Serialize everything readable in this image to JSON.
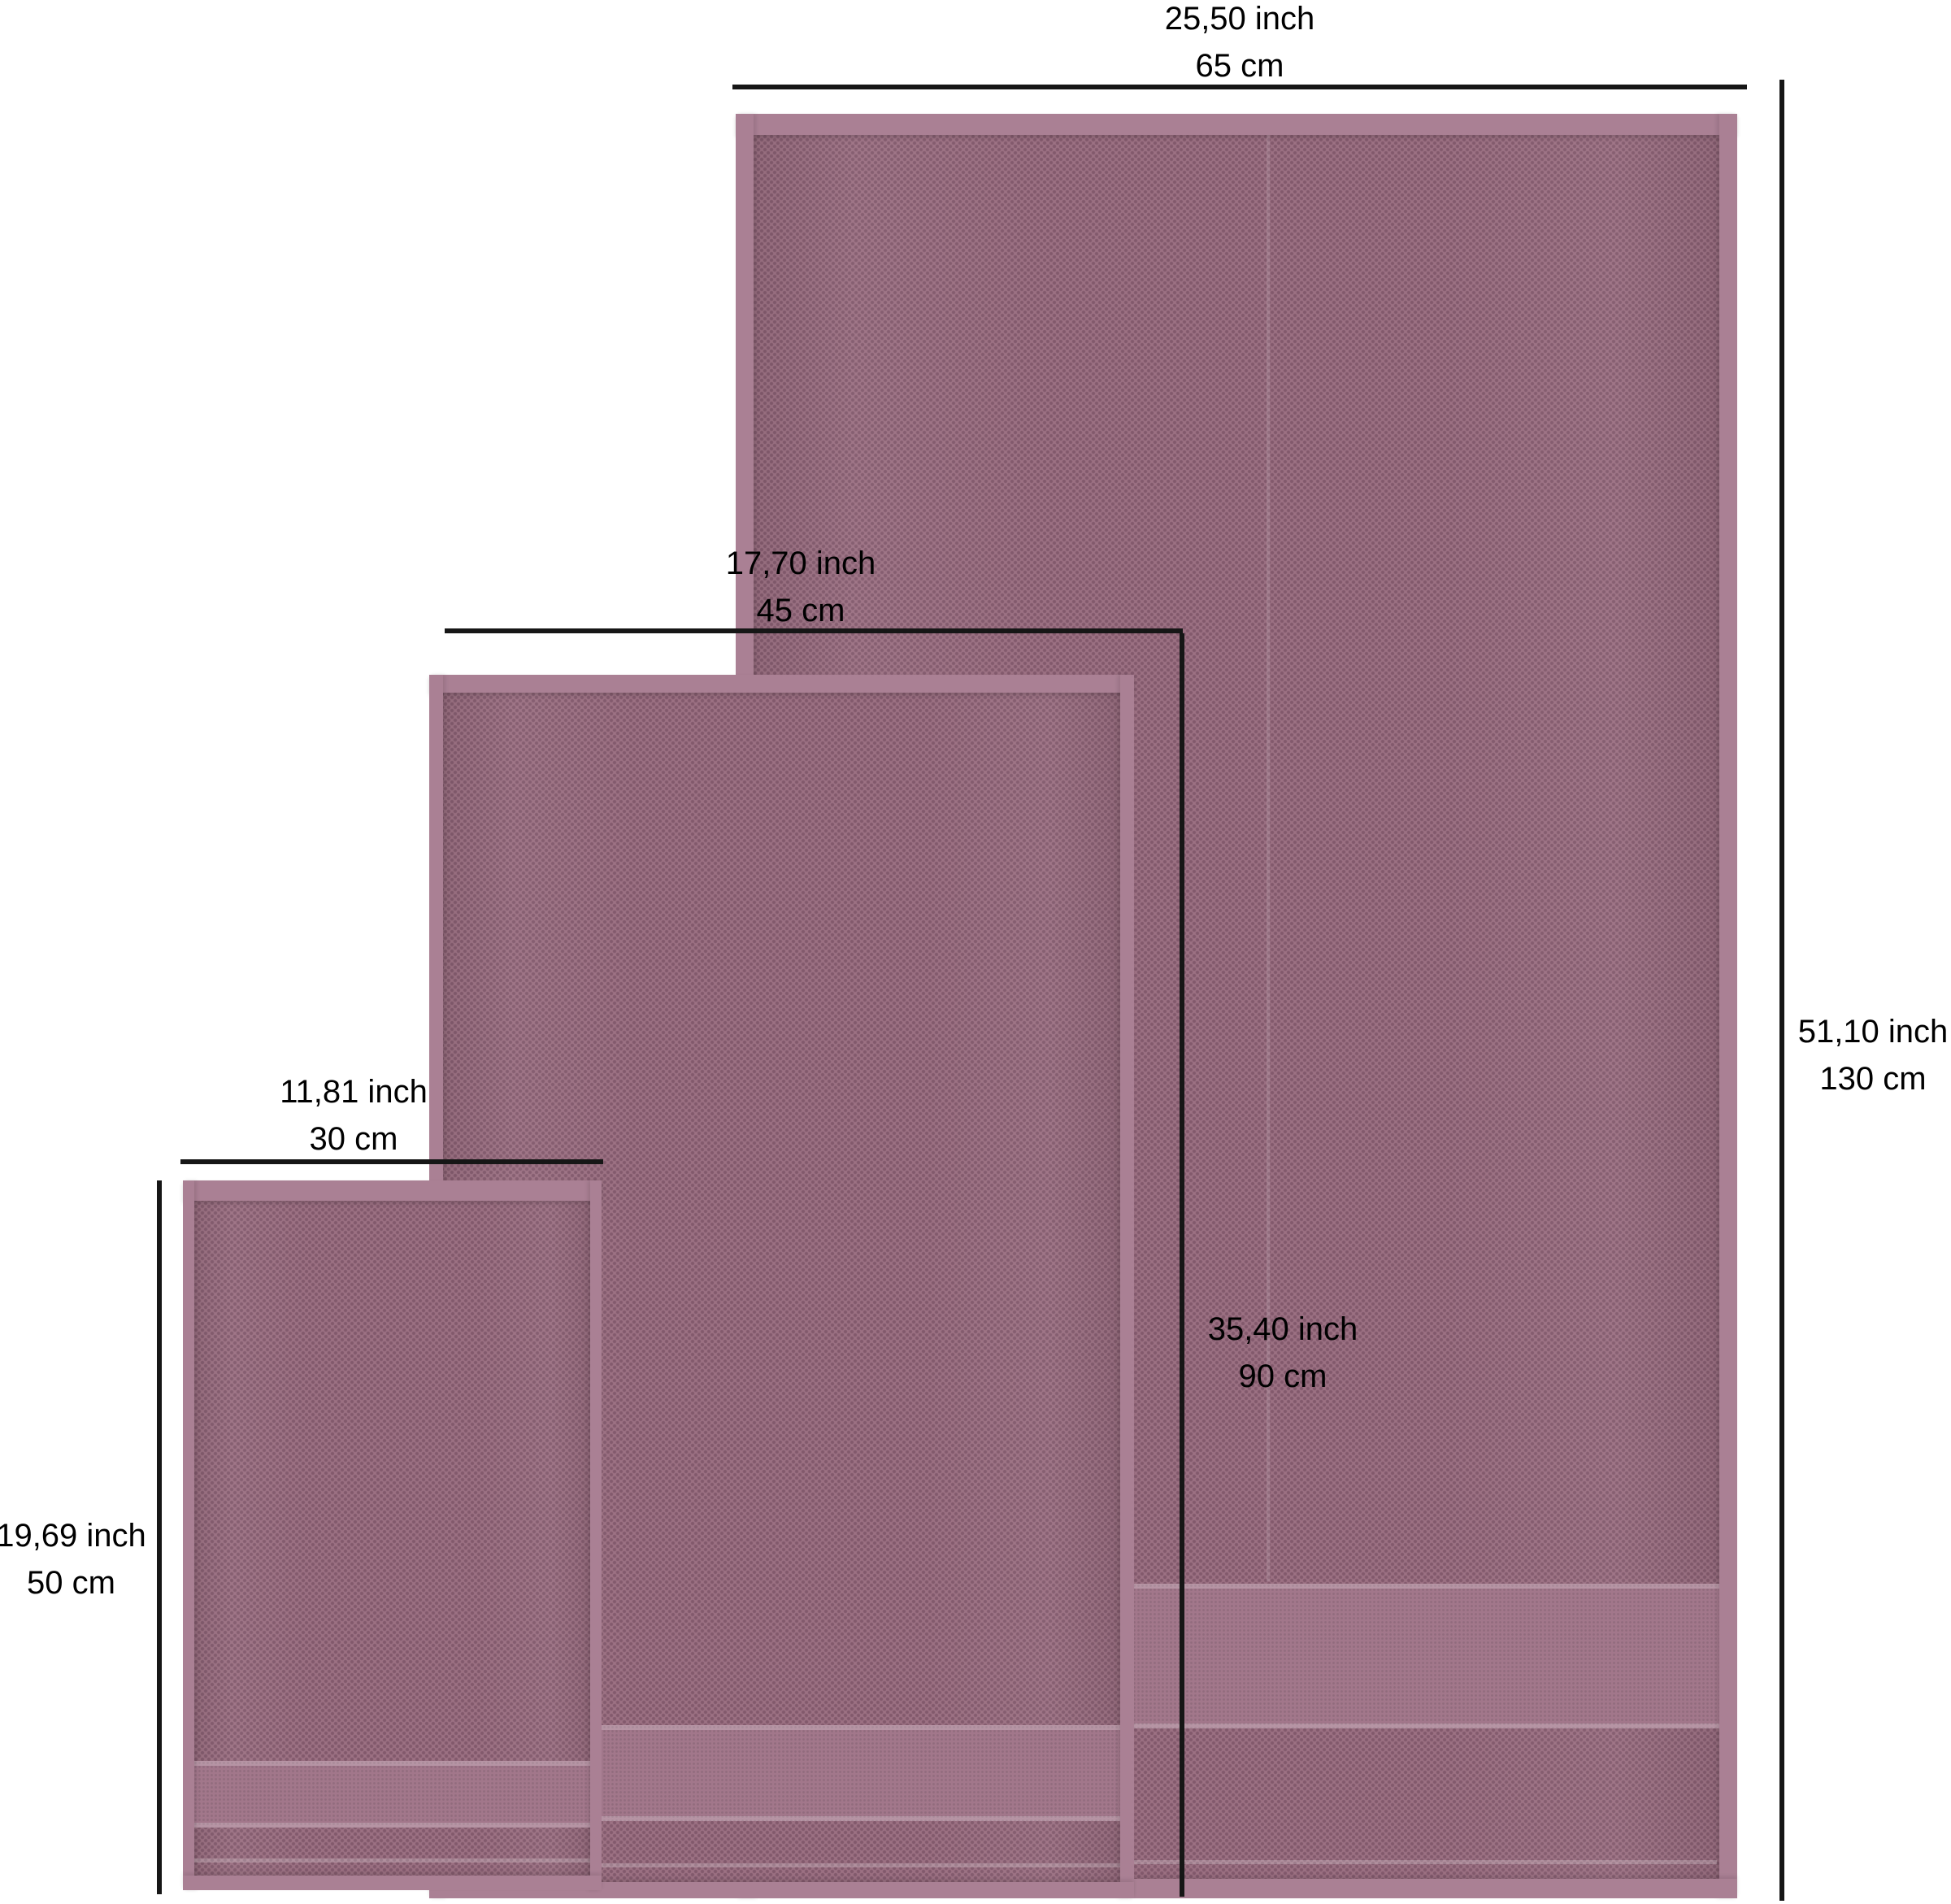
{
  "figure": {
    "title": "Towel size comparison diagram",
    "background_color": "#ffffff",
    "line_color": "#161616",
    "label_color": "#000000",
    "towel_colors": {
      "base": "#9c7183",
      "dot": "#5f3a4e",
      "hem": "#aa8094",
      "band": "#a2778b"
    },
    "towels": [
      {
        "name": "large-towel",
        "width": {
          "inch": "25,50 inch",
          "cm": "65 cm"
        },
        "height": {
          "inch": "51,10 inch",
          "cm": "130 cm"
        }
      },
      {
        "name": "medium-towel",
        "width": {
          "inch": "17,70 inch",
          "cm": "45 cm"
        },
        "height": {
          "inch": "35,40 inch",
          "cm": "90 cm"
        }
      },
      {
        "name": "small-towel",
        "width": {
          "inch": "11,81 inch",
          "cm": "30 cm"
        },
        "height": {
          "inch": "19,69 inch",
          "cm": "50 cm"
        }
      }
    ]
  }
}
